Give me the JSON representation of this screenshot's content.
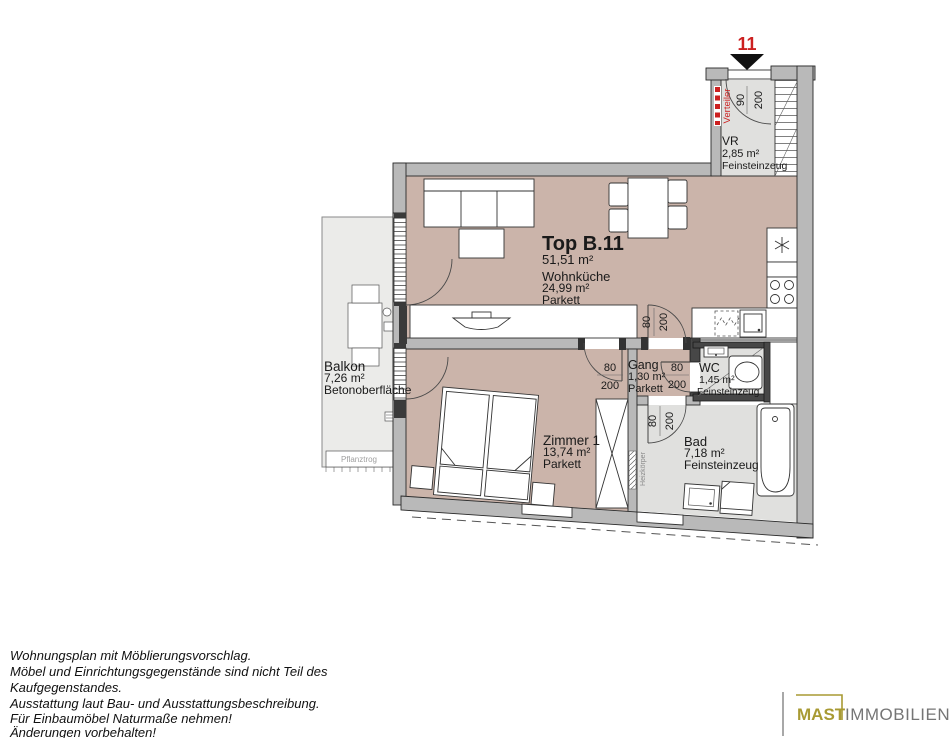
{
  "plan": {
    "unit_marker": {
      "number": "11"
    },
    "title": {
      "name": "Top B.11",
      "total_area": "51,51 m²"
    },
    "rooms": {
      "wohnkueche": {
        "name": "Wohnküche",
        "area": "24,99 m²",
        "flooring": "Parkett"
      },
      "vr": {
        "name": "VR",
        "area": "2,85 m²",
        "flooring": "Feinsteinzeug"
      },
      "gang": {
        "name": "Gang",
        "area": "1,30 m²",
        "flooring": "Parkett"
      },
      "wc": {
        "name": "WC",
        "area": "1,45 m²",
        "flooring": "Feinsteinzeug"
      },
      "bad": {
        "name": "Bad",
        "area": "7,18 m²",
        "flooring": "Feinsteinzeug"
      },
      "zimmer1": {
        "name": "Zimmer 1",
        "area": "13,74 m²",
        "flooring": "Parkett"
      },
      "balkon": {
        "name": "Balkon",
        "area": "7,26 m²",
        "flooring": "Betonoberfläche"
      }
    },
    "doors": {
      "entrance": {
        "w": "90",
        "h": "200"
      },
      "wohnkueche_gang": {
        "w": "80",
        "h": "200"
      },
      "zimmer1": {
        "w": "80",
        "h": "200"
      },
      "wc": {
        "w": "80",
        "h": "200"
      },
      "bad": {
        "w": "80",
        "h": "200"
      }
    },
    "annotations": {
      "verteiler": "Verteiler",
      "heizkoerper": "Heizkörper",
      "pflanztrog": "Pflanztrog"
    },
    "colors": {
      "floor_living": "#cbb4aa",
      "floor_tile": "#e0e0de",
      "floor_balcony": "#ebebe9",
      "wall": "#b9b9b9",
      "accent_red": "#cc2020",
      "logo_gold": "#a89a33",
      "logo_gray": "#757575"
    }
  },
  "footer": {
    "disclaimer_lines": [
      "Wohnungsplan mit Möblierungsvorschlag.",
      "Möbel und Einrichtungsgegenstände sind nicht Teil des",
      "Kaufgegenstandes.",
      "Ausstattung laut Bau- und Ausstattungsbeschreibung.",
      "Für Einbaumöbel Naturmaße nehmen!",
      "Änderungen vorbehalten!"
    ],
    "logo": {
      "brand": "MAST",
      "suffix": "IMMOBILIEN"
    }
  }
}
